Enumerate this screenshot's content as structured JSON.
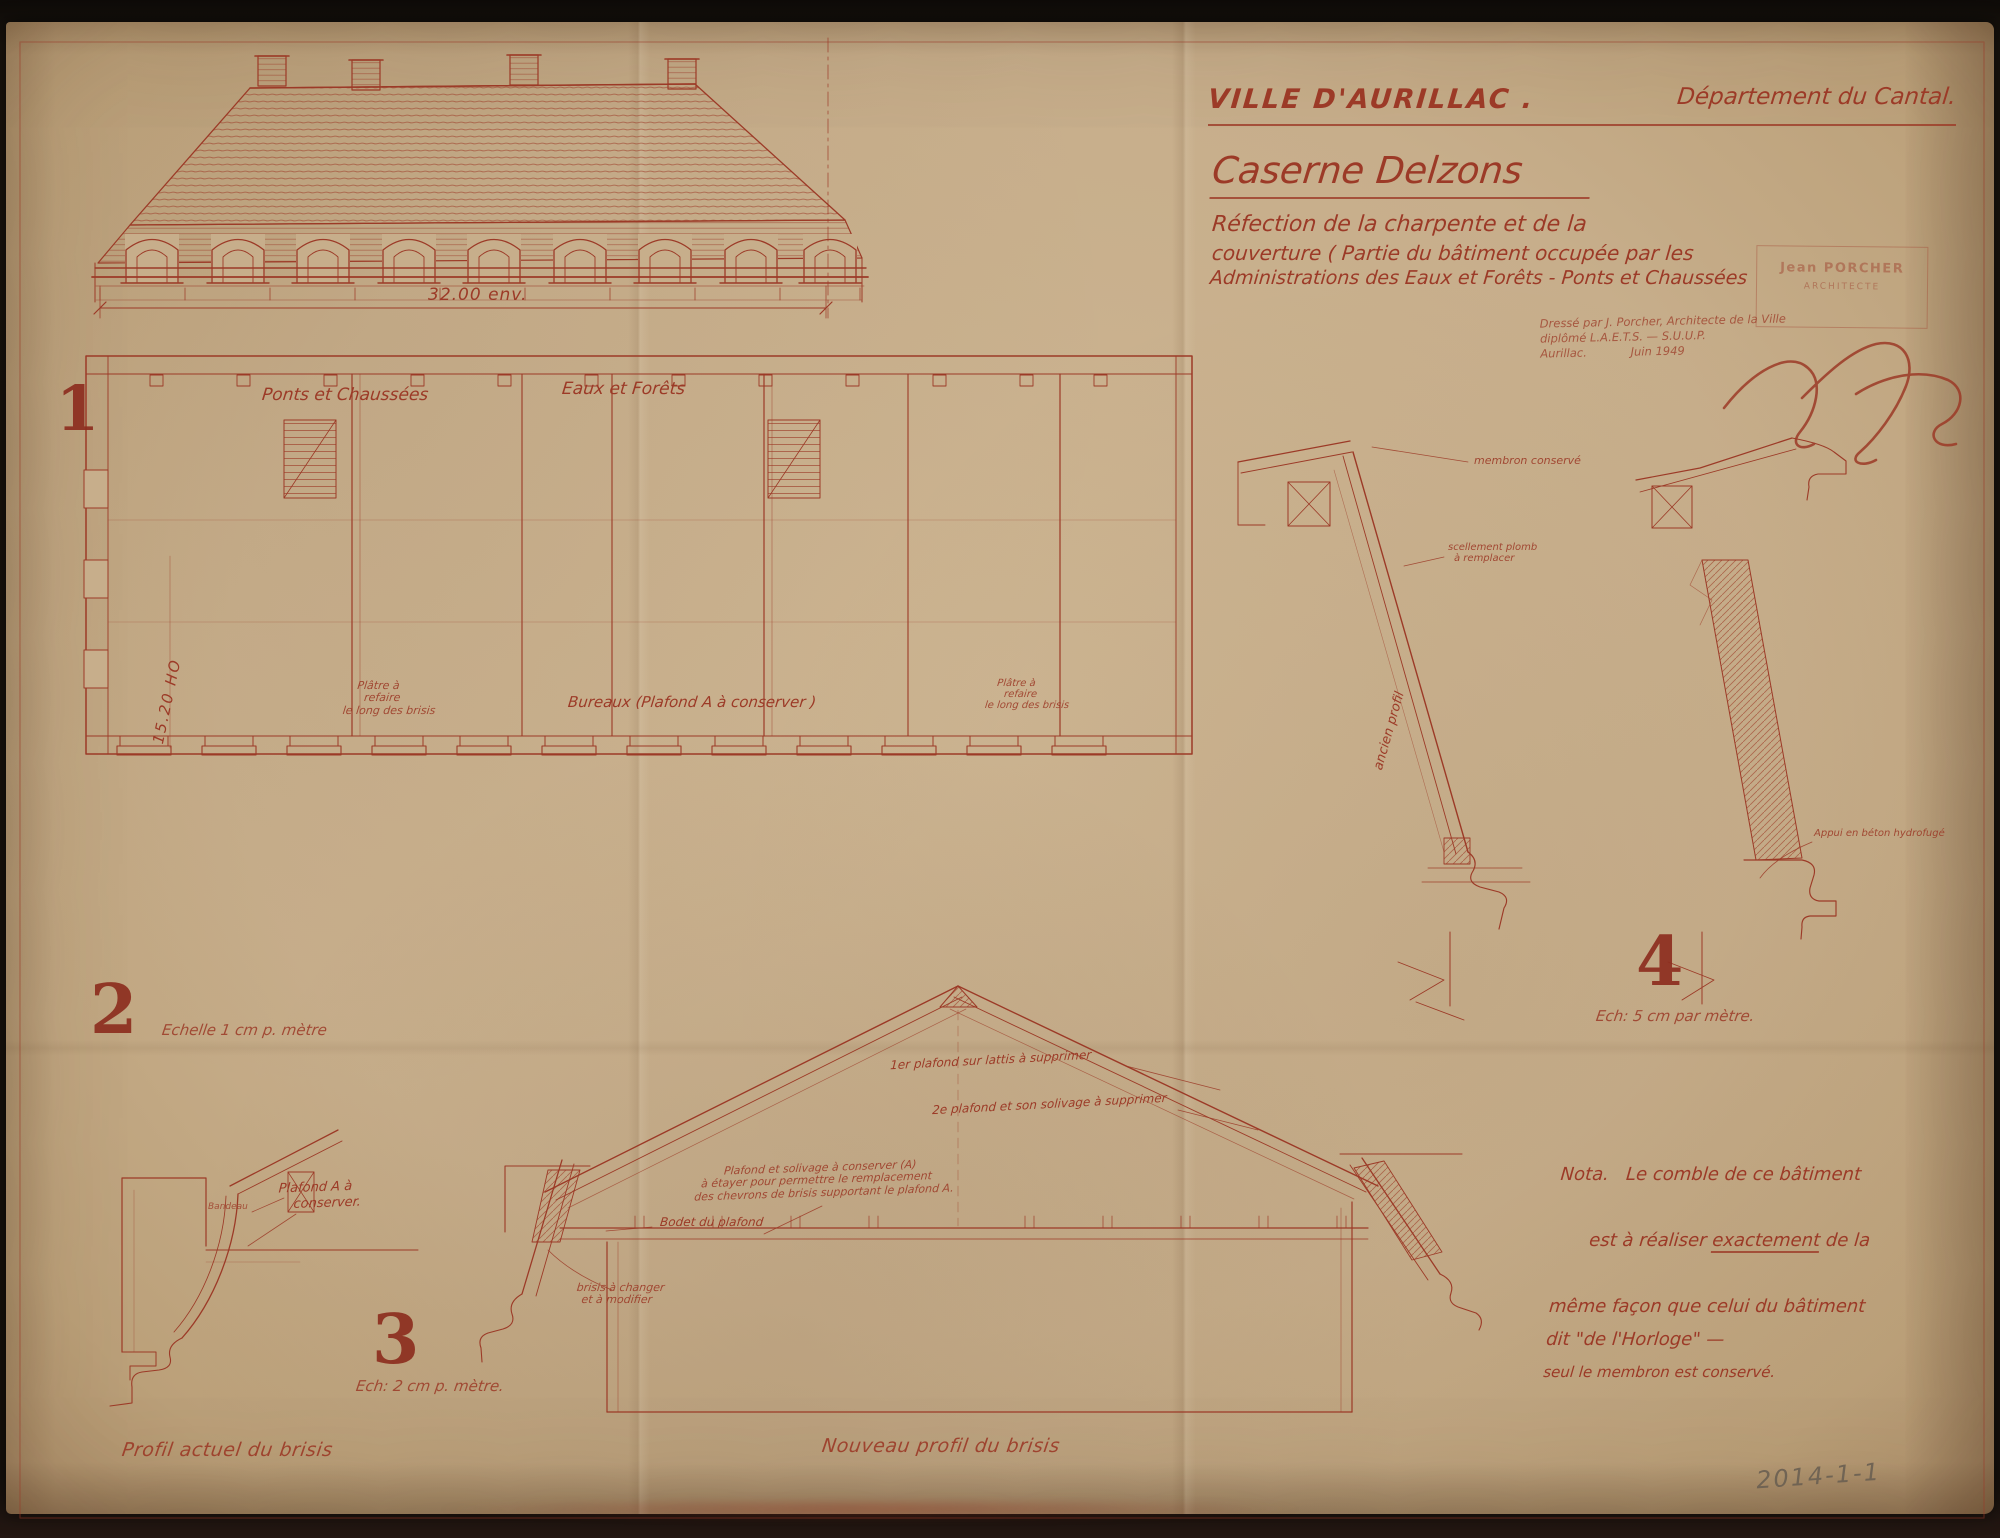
{
  "colors": {
    "ink": "#9c3a27",
    "paper": "#c7ae8b",
    "pencil": "#6b6052"
  },
  "title_block": {
    "city": "VILLE D'AURILLAC .",
    "department": "Département du Cantal.",
    "project": "Caserne Delzons",
    "sub1": "Réfection de la charpente et de la",
    "sub2": "couverture ( Partie du bâtiment occupée par les",
    "sub3": "Administrations des Eaux et Forêts - Ponts et Chaussées",
    "credit1": "Dressé par J. Porcher, Architecte de la Ville",
    "credit2": "diplômé L.A.E.T.S. — S.U.U.P.",
    "credit3": "Aurillac.            Juin 1949",
    "stamp_name": "Jean PORCHER",
    "stamp_title": "ARCHITECTE"
  },
  "figures": {
    "f1": {
      "num": "1"
    },
    "f2": {
      "num": "2",
      "scale": "Echelle 1 cm p. mètre"
    },
    "f3": {
      "num": "3",
      "scale": "Ech: 2 cm p. mètre."
    },
    "f4": {
      "num": "4",
      "scale": "Ech: 5 cm par mètre."
    }
  },
  "plan": {
    "length_dim": "32.00 env.",
    "height_dim": "15.20 HO",
    "zone_left": "Ponts et Chaussées",
    "zone_right": "Eaux et Forêts",
    "room_center": "Bureaux   (Plafond A à conserver )",
    "platre_l1": "Plâtre à",
    "platre_l2": "refaire",
    "platre_l3": "le long des brisis"
  },
  "detail4": {
    "membron": "membron conservé",
    "plomb1": "scellement plomb",
    "plomb2": "à remplacer",
    "ancien_profil": "ancien profil",
    "appui": "Appui en béton hydrofugé"
  },
  "section3": {
    "ann1": "1er plafond sur lattis à supprimer",
    "ann2": "2e plafond et son solivage à supprimer",
    "ann3_l1": "Plafond et solivage à conserver (A)",
    "ann3_l2": "à étayer pour permettre le remplacement",
    "ann3_l3": "des chevrons de brisis supportant le plafond A.",
    "bodet": "Bodet du plafond",
    "brisis1": "brisis à changer",
    "brisis2": "et à modifier"
  },
  "profil_actuel": {
    "plafond1": "Plafond A à",
    "plafond2": "conserver.",
    "bandeau": "Bandeau"
  },
  "captions": {
    "left": "Profil actuel du brisis",
    "center": "Nouveau profil du brisis"
  },
  "nota": {
    "l1": "Nota.   Le comble de ce bâtiment",
    "l2a": "est à réaliser ",
    "l2b": "exactement",
    "l2c": " de la",
    "l3": "même façon que celui du bâtiment",
    "l4": "dit \"de l'Horloge\" —",
    "l5": "seul le membron est conservé."
  },
  "pencil_ref": "2014-1-1"
}
